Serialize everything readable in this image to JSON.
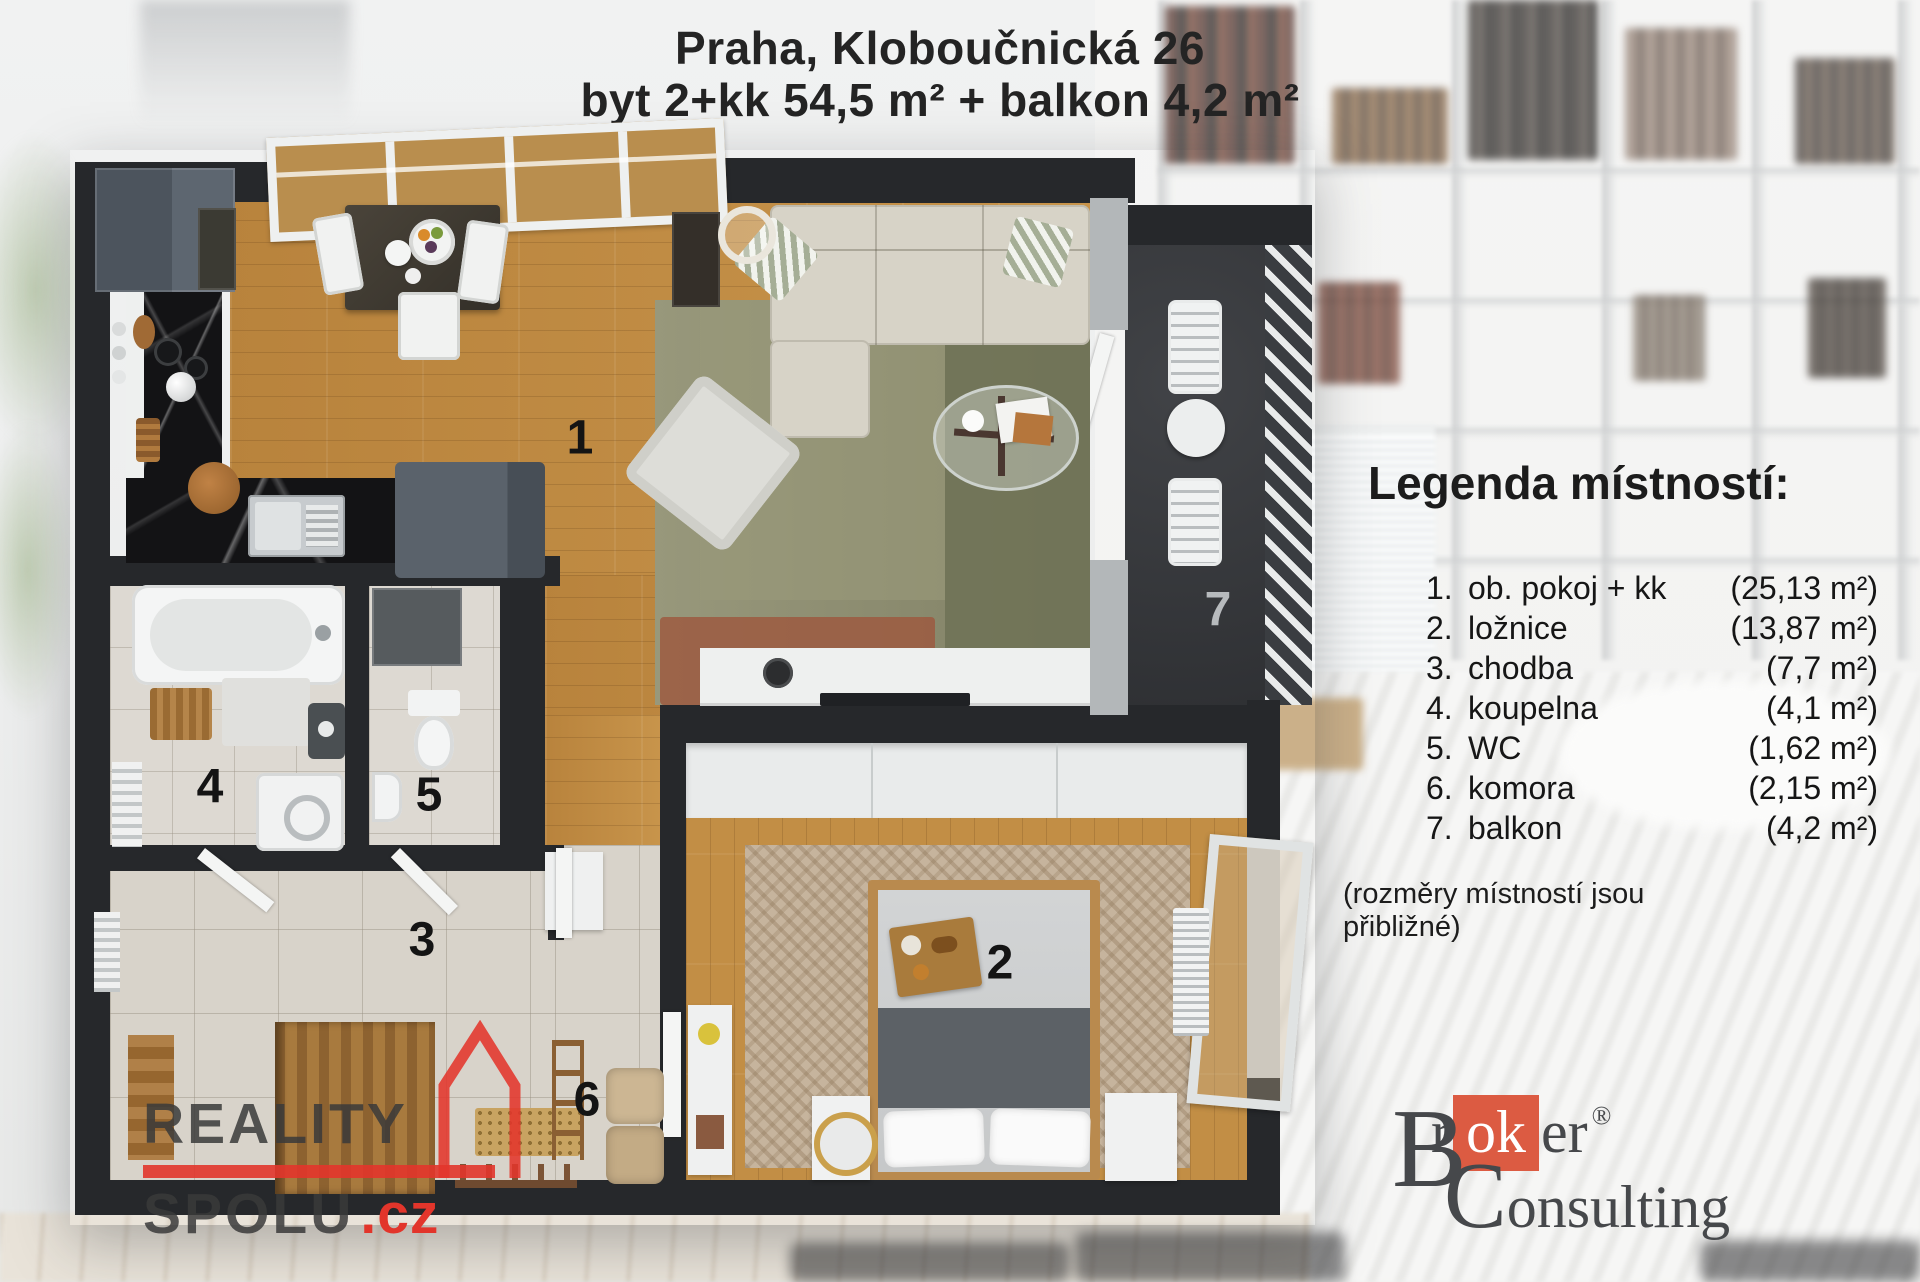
{
  "title": {
    "line1": "Praha, Kloboučnická 26",
    "line2": "byt 2+kk 54,5 m² + balkon 4,2 m²"
  },
  "legend": {
    "heading": "Legenda místností:",
    "items": [
      {
        "num": "1.",
        "name": "ob. pokoj + kk",
        "area": "(25,13 m²)"
      },
      {
        "num": "2.",
        "name": "ložnice",
        "area": "(13,87 m²)"
      },
      {
        "num": "3.",
        "name": "chodba",
        "area": "(7,7 m²)"
      },
      {
        "num": "4.",
        "name": "koupelna",
        "area": "(4,1 m²)"
      },
      {
        "num": "5.",
        "name": "WC",
        "area": "(1,62 m²)"
      },
      {
        "num": "6.",
        "name": "komora",
        "area": "(2,15 m²)"
      },
      {
        "num": "7.",
        "name": "balkon",
        "area": "(4,2 m²)"
      }
    ],
    "note": "(rozměry místností jsou přibližné)"
  },
  "plan_labels": [
    "1",
    "2",
    "3",
    "4",
    "5",
    "6",
    "7"
  ],
  "logos": {
    "reality": {
      "word1": "REALITY",
      "word2": "SPOLU",
      "tld": ".cz"
    },
    "broker": {
      "cap1": "B",
      "mid1": "r",
      "highlight": "ok",
      "tail1": "er",
      "registered": "®",
      "cap2": "C",
      "tail2": "onsulting"
    }
  },
  "colors": {
    "reality_red": "#e2352b",
    "broker_orange": "#dc5b42",
    "wall_charcoal": "#26282b",
    "wood_floor": "#c08b42",
    "tile_floor": "#d8d3ca",
    "balcony_floor": "#37393d",
    "sofa_beige": "#d7d3c7",
    "rug_olive": "#8f8f70"
  }
}
